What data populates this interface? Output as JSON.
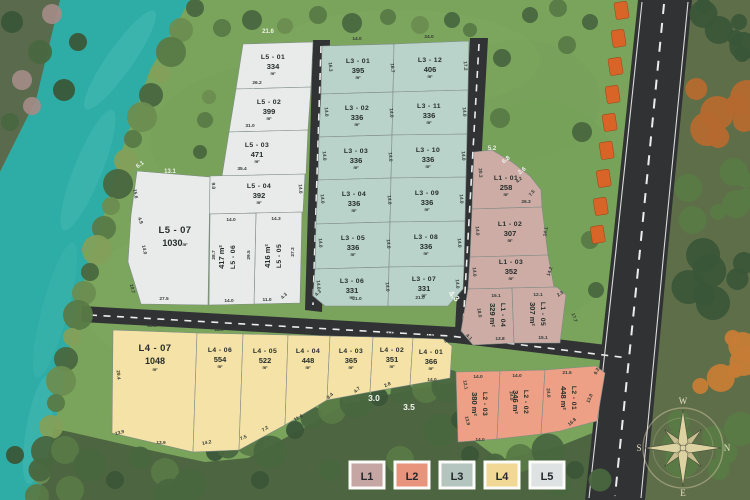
{
  "legend": {
    "items": [
      {
        "label": "L1",
        "color": "#c5a6a2"
      },
      {
        "label": "L2",
        "color": "#e8947c"
      },
      {
        "label": "L3",
        "color": "#b4c4be"
      },
      {
        "label": "L4",
        "color": "#f1d894"
      },
      {
        "label": "L5",
        "color": "#dee2e3"
      }
    ]
  },
  "compass": {
    "top": "W",
    "left": "S",
    "right": "N",
    "bottom": "E"
  },
  "plots": [
    {
      "id": "l5-01",
      "grp": "L5",
      "name": "L5 - 01",
      "area": "334",
      "unit": "m²",
      "pts": "243,44 313,42 311,87 236,89",
      "lx": 273,
      "ly": 59,
      "rot": 0
    },
    {
      "id": "l5-02",
      "grp": "L5",
      "name": "L5 - 02",
      "area": "399",
      "unit": "m²",
      "pts": "236,89 311,87 308,130 229,132",
      "lx": 269,
      "ly": 104,
      "rot": 0
    },
    {
      "id": "l5-03",
      "grp": "L5",
      "name": "L5 - 03",
      "area": "471",
      "unit": "m²",
      "pts": "229,132 308,130 306,174 222,176",
      "lx": 257,
      "ly": 147,
      "rot": 0
    },
    {
      "id": "l5-04",
      "grp": "L5",
      "name": "L5 - 04",
      "area": "392",
      "unit": "m²",
      "pts": "210,176 305,174 303,212 208,214",
      "lx": 259,
      "ly": 188,
      "rot": 0
    },
    {
      "id": "l5-05",
      "grp": "L5",
      "name": "L5 - 05",
      "area": "416",
      "unit": "m²",
      "pts": "256,213 302,212 300,303 254,304",
      "lx": 277,
      "ly": 256,
      "rot": -90
    },
    {
      "id": "l5-06",
      "grp": "L5",
      "name": "L5 - 06",
      "area": "417",
      "unit": "m²",
      "pts": "210,214 256,213 254,304 209,305",
      "lx": 231,
      "ly": 257,
      "rot": -90
    },
    {
      "id": "l5-07",
      "grp": "L5",
      "name": "L5 - 07",
      "area": "1030",
      "unit": "m²",
      "pts": "137,171 210,177 208,305 141,304 128,262 131,215",
      "lx": 175,
      "ly": 233,
      "rot": 0,
      "big": true,
      "inline": true
    },
    {
      "id": "l3-01",
      "grp": "L3",
      "name": "L3 - 01",
      "area": "395",
      "unit": "m²",
      "pts": "322,46 394,44 393,92 321,94",
      "lx": 358,
      "ly": 63,
      "rot": 0
    },
    {
      "id": "l3-02",
      "grp": "L3",
      "name": "L3 - 02",
      "area": "336",
      "unit": "m²",
      "pts": "321,94 393,92 392,135 319,137",
      "lx": 357,
      "ly": 110,
      "rot": 0
    },
    {
      "id": "l3-03",
      "grp": "L3",
      "name": "L3 - 03",
      "area": "336",
      "unit": "m²",
      "pts": "319,137 392,135 391,178 318,180",
      "lx": 356,
      "ly": 153,
      "rot": 0
    },
    {
      "id": "l3-04",
      "grp": "L3",
      "name": "L3 - 04",
      "area": "336",
      "unit": "m²",
      "pts": "318,180 391,178 390,222 316,224",
      "lx": 354,
      "ly": 196,
      "rot": 0
    },
    {
      "id": "l3-05",
      "grp": "L3",
      "name": "L3 - 05",
      "area": "336",
      "unit": "m²",
      "pts": "316,224 390,222 389,267 315,269",
      "lx": 353,
      "ly": 240,
      "rot": 0
    },
    {
      "id": "l3-06",
      "grp": "L3",
      "name": "L3 - 06",
      "area": "331",
      "unit": "m²",
      "pts": "315,269 389,267 388,306 325,306 313,296",
      "lx": 352,
      "ly": 283,
      "rot": 0
    },
    {
      "id": "l3-12",
      "grp": "L3",
      "name": "L3 - 12",
      "area": "406",
      "unit": "m²",
      "pts": "394,44 469,41 468,90 393,92",
      "lx": 430,
      "ly": 62,
      "rot": 0
    },
    {
      "id": "l3-11",
      "grp": "L3",
      "name": "L3 - 11",
      "area": "336",
      "unit": "m²",
      "pts": "393,92 468,90 467,134 392,135",
      "lx": 429,
      "ly": 108,
      "rot": 0
    },
    {
      "id": "l3-10",
      "grp": "L3",
      "name": "L3 - 10",
      "area": "336",
      "unit": "m²",
      "pts": "392,135 467,134 466,177 391,178",
      "lx": 428,
      "ly": 152,
      "rot": 0
    },
    {
      "id": "l3-09",
      "grp": "L3",
      "name": "L3 - 09",
      "area": "336",
      "unit": "m²",
      "pts": "391,178 466,177 465,221 390,222",
      "lx": 427,
      "ly": 195,
      "rot": 0
    },
    {
      "id": "l3-08",
      "grp": "L3",
      "name": "L3 - 08",
      "area": "336",
      "unit": "m²",
      "pts": "390,222 465,221 464,266 389,267",
      "lx": 426,
      "ly": 239,
      "rot": 0
    },
    {
      "id": "l3-07",
      "grp": "L3",
      "name": "L3 - 07",
      "area": "331",
      "unit": "m²",
      "pts": "389,267 464,266 463,289 448,306 388,306",
      "lx": 424,
      "ly": 281,
      "rot": 0
    },
    {
      "id": "l1-01",
      "grp": "L1",
      "name": "L1 - 01",
      "area": "258",
      "unit": "m²",
      "pts": "474,152 492,150 512,162 530,176 541,190 542,207 472,209",
      "lx": 506,
      "ly": 180,
      "rot": 0
    },
    {
      "id": "l1-02",
      "grp": "L1",
      "name": "L1 - 02",
      "area": "307",
      "unit": "m²",
      "pts": "472,209 542,207 548,255 470,257",
      "lx": 510,
      "ly": 226,
      "rot": 0
    },
    {
      "id": "l1-03",
      "grp": "L1",
      "name": "L1 - 03",
      "area": "352",
      "unit": "m²",
      "pts": "470,257 548,255 554,287 468,289",
      "lx": 511,
      "ly": 264,
      "rot": 0
    },
    {
      "id": "l1-04",
      "grp": "L1",
      "name": "L1 - 04",
      "area": "329",
      "unit": "m²",
      "pts": "468,289 512,288 514,343 473,345 461,331",
      "lx": 497,
      "ly": 315,
      "rot": 90
    },
    {
      "id": "l1-05",
      "grp": "L1",
      "name": "L1 - 05",
      "area": "307",
      "unit": "m²",
      "pts": "512,288 557,287 566,295 560,343 514,343",
      "lx": 537,
      "ly": 314,
      "rot": 90
    },
    {
      "id": "l4-07",
      "grp": "L4",
      "name": "L4 - 07",
      "area": "1048",
      "unit": "m²",
      "pts": "113,330 197,333 193,452 112,433",
      "lx": 155,
      "ly": 351,
      "rot": 0,
      "big": true
    },
    {
      "id": "l4-06",
      "grp": "L4",
      "name": "L4 - 06",
      "area": "554",
      "unit": "m²",
      "pts": "197,333 243,334 239,450 193,452",
      "lx": 220,
      "ly": 352,
      "rot": 0
    },
    {
      "id": "l4-05",
      "grp": "L4",
      "name": "L4 - 05",
      "area": "522",
      "unit": "m²",
      "pts": "243,334 288,335 285,425 239,450",
      "lx": 265,
      "ly": 353,
      "rot": 0
    },
    {
      "id": "l4-04",
      "grp": "L4",
      "name": "L4 - 04",
      "area": "448",
      "unit": "m²",
      "pts": "288,335 330,336 327,400 285,425",
      "lx": 308,
      "ly": 353,
      "rot": 0
    },
    {
      "id": "l4-03",
      "grp": "L4",
      "name": "L4 - 03",
      "area": "365",
      "unit": "m²",
      "pts": "330,336 373,337 370,392 327,400",
      "lx": 351,
      "ly": 353,
      "rot": 0
    },
    {
      "id": "l4-02",
      "grp": "L4",
      "name": "L4 - 02",
      "area": "351",
      "unit": "m²",
      "pts": "373,337 413,338 410,385 370,392",
      "lx": 392,
      "ly": 352,
      "rot": 0
    },
    {
      "id": "l4-01",
      "grp": "L4",
      "name": "L4 - 01",
      "area": "366",
      "unit": "m²",
      "pts": "413,338 443,339 452,346 450,378 410,385",
      "lx": 431,
      "ly": 354,
      "rot": 0
    },
    {
      "id": "l2-03",
      "grp": "L2",
      "name": "L2 - 03",
      "area": "380",
      "unit": "m²",
      "pts": "456,372 500,371 497,439 458,442",
      "lx": 479,
      "ly": 404,
      "rot": 90
    },
    {
      "id": "l2-02",
      "grp": "L2",
      "name": "L2 - 02",
      "area": "346",
      "unit": "m²",
      "pts": "500,371 545,370 541,434 497,439",
      "lx": 520,
      "ly": 402,
      "rot": 90
    },
    {
      "id": "l2-01",
      "grp": "L2",
      "name": "L2 - 01",
      "area": "448",
      "unit": "m²",
      "pts": "545,370 596,366 605,373 597,421 560,431 541,434",
      "lx": 568,
      "ly": 398,
      "rot": 90
    }
  ],
  "dims": [
    [
      "21.6",
      268,
      33,
      0,
      "w"
    ],
    [
      "26.2",
      257,
      84,
      0,
      "d"
    ],
    [
      "31.0",
      250,
      127,
      0,
      "d"
    ],
    [
      "35.4",
      242,
      170,
      0,
      "d"
    ],
    [
      "6.1",
      141,
      166,
      -35,
      "w"
    ],
    [
      "13.1",
      170,
      173,
      0,
      "w"
    ],
    [
      "15.6",
      134,
      194,
      80,
      "d"
    ],
    [
      "4.9",
      139,
      221,
      70,
      "d"
    ],
    [
      "14.0",
      143,
      250,
      78,
      "d"
    ],
    [
      "10.7",
      131,
      289,
      75,
      "d"
    ],
    [
      "27.5",
      164,
      300,
      0,
      "d"
    ],
    [
      "9.0",
      212,
      186,
      85,
      "d"
    ],
    [
      "14.0",
      299,
      189,
      85,
      "d"
    ],
    [
      "14.0",
      231,
      221,
      0,
      "d"
    ],
    [
      "14.3",
      276,
      220,
      0,
      "d"
    ],
    [
      "28.7",
      215,
      255,
      -90,
      "d"
    ],
    [
      "29.5",
      250,
      255,
      -90,
      "d"
    ],
    [
      "27.3",
      294,
      252,
      -90,
      "d"
    ],
    [
      "14.0",
      229,
      302,
      0,
      "d"
    ],
    [
      "11.0",
      267,
      301,
      0,
      "d"
    ],
    [
      "4.3",
      285,
      297,
      -45,
      "d"
    ],
    [
      "14.0",
      357,
      40,
      0,
      "d"
    ],
    [
      "24.0",
      429,
      38,
      0,
      "d"
    ],
    [
      "16.3",
      329,
      67,
      85,
      "d"
    ],
    [
      "16.7",
      391,
      68,
      85,
      "d"
    ],
    [
      "17.2",
      464,
      66,
      85,
      "d"
    ],
    [
      "14.0",
      325,
      112,
      85,
      "d"
    ],
    [
      "14.0",
      390,
      113,
      85,
      "d"
    ],
    [
      "14.0",
      463,
      112,
      85,
      "d"
    ],
    [
      "14.0",
      323,
      156,
      85,
      "d"
    ],
    [
      "14.0",
      389,
      157,
      85,
      "d"
    ],
    [
      "14.0",
      462,
      156,
      85,
      "d"
    ],
    [
      "14.0",
      321,
      199,
      85,
      "d"
    ],
    [
      "14.0",
      388,
      200,
      85,
      "d"
    ],
    [
      "14.0",
      460,
      199,
      85,
      "d"
    ],
    [
      "14.0",
      319,
      243,
      85,
      "d"
    ],
    [
      "14.0",
      387,
      244,
      85,
      "d"
    ],
    [
      "14.0",
      458,
      243,
      85,
      "d"
    ],
    [
      "14.0",
      317,
      285,
      85,
      "d"
    ],
    [
      "14.0",
      386,
      287,
      85,
      "d"
    ],
    [
      "14.0",
      456,
      284,
      85,
      "d"
    ],
    [
      "21.0",
      357,
      300,
      0,
      "d"
    ],
    [
      "21.0",
      420,
      299,
      0,
      "d"
    ],
    [
      "4.3",
      319,
      294,
      -45,
      "d"
    ],
    [
      "4.3",
      452,
      298,
      45,
      "W"
    ],
    [
      "5.2",
      492,
      150,
      0,
      "w"
    ],
    [
      "6.8",
      507,
      161,
      -38,
      "w"
    ],
    [
      "2.6",
      523,
      172,
      -38,
      "w"
    ],
    [
      "4.2",
      520,
      181,
      -42,
      "d"
    ],
    [
      "7.5",
      533,
      194,
      -52,
      "d"
    ],
    [
      "20.3",
      479,
      173,
      85,
      "d"
    ],
    [
      "26.3",
      526,
      203,
      0,
      "d"
    ],
    [
      "14.0",
      476,
      231,
      85,
      "d"
    ],
    [
      "14.1",
      547,
      232,
      -80,
      "d"
    ],
    [
      "14.0",
      473,
      272,
      85,
      "d"
    ],
    [
      "14.2",
      551,
      272,
      -70,
      "d"
    ],
    [
      "15.1",
      496,
      297,
      0,
      "d"
    ],
    [
      "12.1",
      538,
      296,
      0,
      "d"
    ],
    [
      "18.0",
      478,
      313,
      80,
      "d"
    ],
    [
      "4.1",
      468,
      338,
      45,
      "d"
    ],
    [
      "13.8",
      500,
      340,
      0,
      "d"
    ],
    [
      "15.1",
      543,
      339,
      0,
      "d"
    ],
    [
      "2.3",
      561,
      295,
      -35,
      "d"
    ],
    [
      "17.7",
      573,
      318,
      70,
      "d"
    ],
    [
      "23.5",
      152,
      327,
      0,
      "d"
    ],
    [
      "29.4",
      117,
      375,
      85,
      "d"
    ],
    [
      "13.9",
      120,
      434,
      -15,
      "d"
    ],
    [
      "13.9",
      161,
      444,
      0,
      "d"
    ],
    [
      "14.0",
      219,
      331,
      0,
      "d"
    ],
    [
      "14.2",
      207,
      444,
      -12,
      "d"
    ],
    [
      "14.0",
      264,
      332,
      0,
      "d"
    ],
    [
      "7.5",
      244,
      439,
      -25,
      "d"
    ],
    [
      "7.2",
      266,
      430,
      -35,
      "d"
    ],
    [
      "14.0",
      307,
      333,
      0,
      "d"
    ],
    [
      "11.4",
      299,
      419,
      -30,
      "d"
    ],
    [
      "8.4",
      331,
      397,
      -42,
      "d"
    ],
    [
      "14.0",
      351,
      334,
      0,
      "d"
    ],
    [
      "4.7",
      358,
      391,
      -42,
      "d"
    ],
    [
      "14.0",
      392,
      335,
      0,
      "d"
    ],
    [
      "2.8",
      388,
      386,
      -25,
      "d"
    ],
    [
      "11.0",
      429,
      336,
      0,
      "d"
    ],
    [
      "4.3",
      448,
      341,
      -45,
      "d"
    ],
    [
      "14.0",
      432,
      381,
      0,
      "d"
    ],
    [
      "3.0",
      374,
      401,
      0,
      "W"
    ],
    [
      "3.5",
      409,
      410,
      0,
      "W"
    ],
    [
      "14.0",
      478,
      378,
      0,
      "d"
    ],
    [
      "14.0",
      517,
      377,
      0,
      "d"
    ],
    [
      "21.5",
      567,
      374,
      0,
      "d"
    ],
    [
      "9.2",
      598,
      372,
      -62,
      "d"
    ],
    [
      "12.1",
      464,
      385,
      80,
      "d"
    ],
    [
      "13.9",
      466,
      421,
      76,
      "d"
    ],
    [
      "24.0",
      510,
      396,
      85,
      "d"
    ],
    [
      "24.0",
      547,
      393,
      85,
      "d"
    ],
    [
      "13.8",
      591,
      399,
      -66,
      "d"
    ],
    [
      "16.8",
      573,
      423,
      -42,
      "d"
    ],
    [
      "14.0",
      480,
      441,
      0,
      "d"
    ]
  ]
}
